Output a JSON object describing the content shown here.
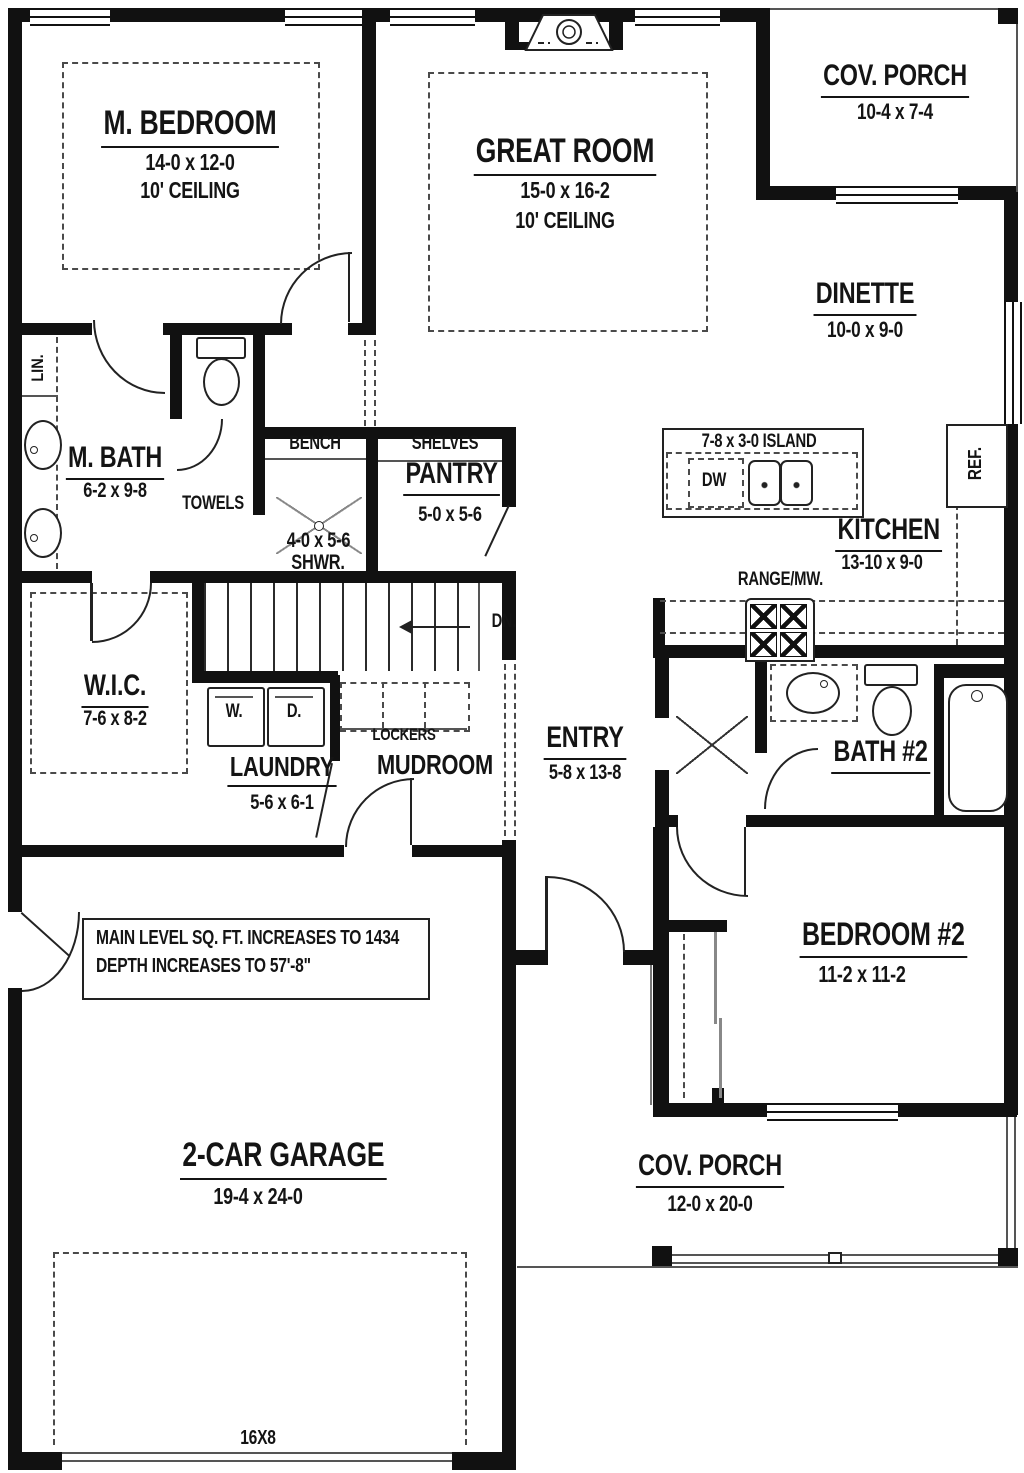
{
  "rooms": {
    "m_bedroom": {
      "name": "M. BEDROOM",
      "dims": "14-0 x 12-0",
      "ceiling": "10' CEILING"
    },
    "great_room": {
      "name": "GREAT ROOM",
      "dims": "15-0 x 16-2",
      "ceiling": "10' CEILING"
    },
    "cov_porch_top": {
      "name": "COV. PORCH",
      "dims": "10-4 x 7-4"
    },
    "dinette": {
      "name": "DINETTE",
      "dims": "10-0 x 9-0"
    },
    "m_bath": {
      "name": "M. BATH",
      "dims": "6-2 x 9-8"
    },
    "shower": {
      "name": "SHWR.",
      "dims": "4-0 x 5-6"
    },
    "pantry": {
      "name": "PANTRY",
      "dims": "5-0 x 5-6"
    },
    "island": {
      "label": "7-8 x 3-0  ISLAND"
    },
    "kitchen": {
      "name": "KITCHEN",
      "dims": "13-10 x 9-0"
    },
    "wic": {
      "name": "W.I.C.",
      "dims": "7-6 x 8-2"
    },
    "laundry": {
      "name": "LAUNDRY",
      "dims": "5-6 x 6-1"
    },
    "mudroom": {
      "name": "MUDROOM"
    },
    "entry": {
      "name": "ENTRY",
      "dims": "5-8 x 13-8"
    },
    "bath2": {
      "name": "BATH #2"
    },
    "bedroom2": {
      "name": "BEDROOM #2",
      "dims": "11-2 x 11-2"
    },
    "garage": {
      "name": "2-CAR GARAGE",
      "dims": "19-4 x 24-0",
      "door": "16X8"
    },
    "cov_porch_bottom": {
      "name": "COV. PORCH",
      "dims": "12-0 x 20-0"
    }
  },
  "fixtures": {
    "lin": "LIN.",
    "towels": "TOWELS",
    "bench": "BENCH",
    "shelves": "SHELVES",
    "dw": "DW",
    "ref": "REF.",
    "range": "RANGE/MW.",
    "washer": "W.",
    "dryer": "D.",
    "lockers": "LOCKERS",
    "dn": "DN."
  },
  "note": {
    "line1": "MAIN LEVEL SQ. FT. INCREASES TO 1434",
    "line2": "DEPTH INCREASES TO 57'-8\""
  },
  "colors": {
    "wall": "#111111",
    "background": "#ffffff",
    "dashed": "#4a4a4a"
  }
}
